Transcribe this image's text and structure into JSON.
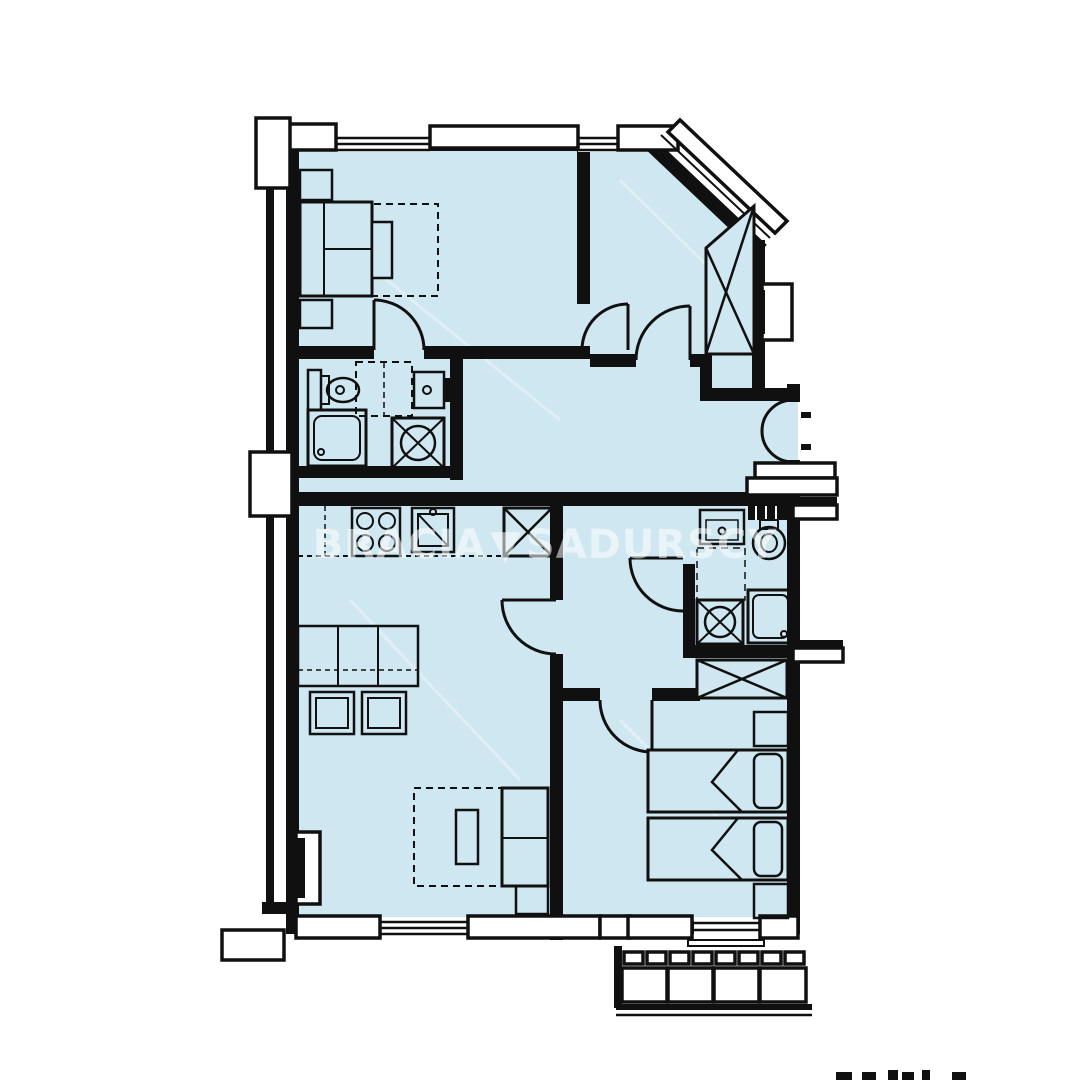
{
  "watermark": {
    "left": "BRACIA",
    "separator": "▼",
    "right": "SADURSCY"
  },
  "footer": {
    "bottom_right_text_fragment": "cropped illegible text"
  },
  "colors": {
    "floor": "#cfe7f1",
    "wall": "#101010",
    "background": "#ffffff",
    "watermark": "#ffffff"
  },
  "plan": {
    "type": "apartment-floor-plan",
    "rooms": [
      {
        "name": "bedroom-1",
        "fixtures": [
          "double-bed",
          "nightstand",
          "nightstand",
          "foot-bench",
          "rug"
        ]
      },
      {
        "name": "ensuite-bathroom",
        "fixtures": [
          "toilet",
          "vanity",
          "washbasin",
          "shower",
          "washing-machine"
        ]
      },
      {
        "name": "bedroom-2",
        "fixtures": [
          "wardrobe",
          "radiator",
          "corner-window"
        ]
      },
      {
        "name": "hallway",
        "fixtures": [
          "entrance-double-door"
        ]
      },
      {
        "name": "kitchen-living-room",
        "fixtures": [
          "cooktop",
          "kitchen-sink",
          "fridge",
          "dining-table",
          "chairs",
          "sofa-bed",
          "radiator"
        ]
      },
      {
        "name": "bathroom-2",
        "fixtures": [
          "washbasin",
          "toilet",
          "washing-machine",
          "shower"
        ]
      },
      {
        "name": "bedroom-3",
        "fixtures": [
          "wardrobe",
          "single-bed",
          "single-bed",
          "nightstand",
          "nightstand"
        ]
      },
      {
        "name": "balcony",
        "fixtures": [
          "railing"
        ]
      },
      {
        "name": "stair-landing",
        "fixtures": [
          "steps"
        ]
      }
    ]
  }
}
